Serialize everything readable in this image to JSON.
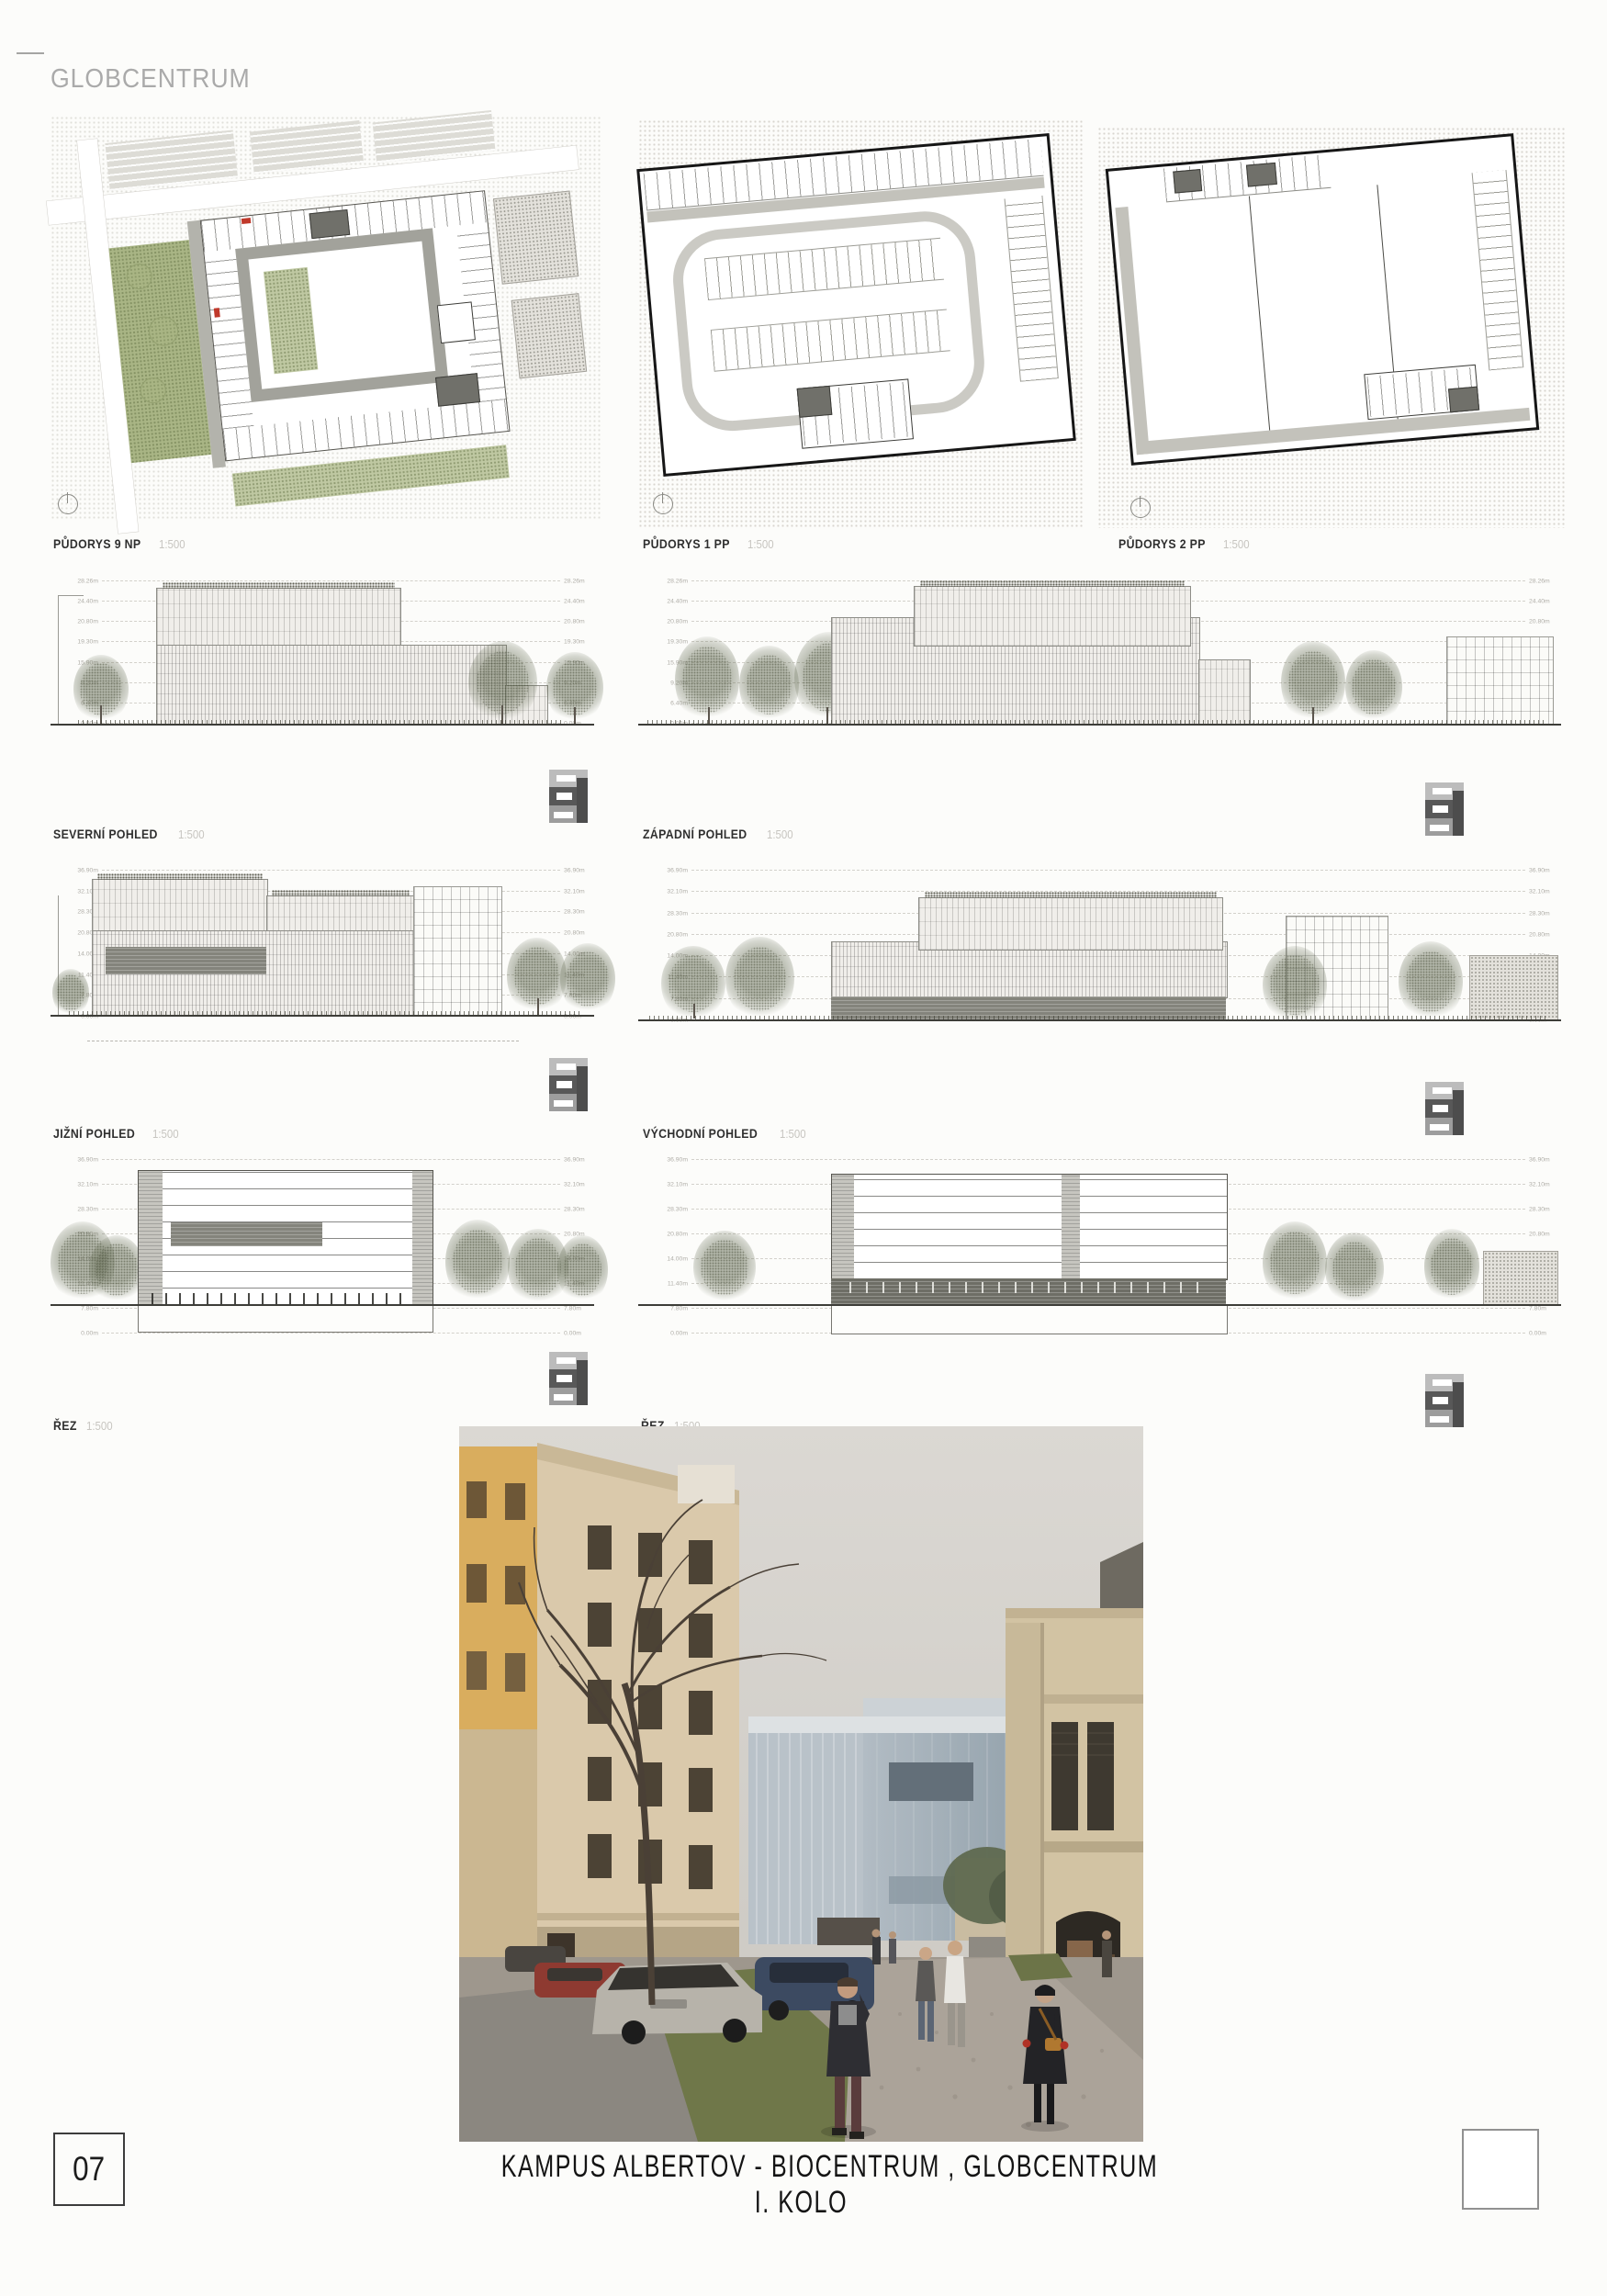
{
  "board": {
    "title": "GLOBCENTRUM",
    "page_number": "07",
    "caption_line1": "KAMPUS ALBERTOV - BIOCENTRUM , GLOBCENTRUM",
    "caption_line2": "I. KOLO"
  },
  "panels": {
    "plan_9np": {
      "label": "PŮDORYS 9 NP",
      "scale": "1:500"
    },
    "plan_1pp": {
      "label": "PŮDORYS 1 PP",
      "scale": "1:500"
    },
    "plan_2pp": {
      "label": "PŮDORYS 2 PP",
      "scale": "1:500"
    },
    "elev_north": {
      "label": "SEVERNÍ POHLED",
      "scale": "1:500"
    },
    "elev_west": {
      "label": "ZÁPADNÍ POHLED",
      "scale": "1:500"
    },
    "elev_south": {
      "label": "JIŽNÍ POHLED",
      "scale": "1:500"
    },
    "elev_east": {
      "label": "VÝCHODNÍ POHLED",
      "scale": "1:500"
    },
    "section_left": {
      "label": "ŘEZ",
      "scale": "1:500"
    },
    "section_right": {
      "label": "ŘEZ",
      "scale": "1:500"
    }
  },
  "levels": {
    "elevation": [
      "28.26m",
      "24.40m",
      "20.80m",
      "19.30m",
      "15.90m",
      "9.20m",
      "6.40m",
      "0.00m"
    ],
    "section": [
      "36.90m",
      "32.10m",
      "28.30m",
      "20.80m",
      "14.00m",
      "11.40m",
      "7.80m",
      "0.00m"
    ]
  },
  "colors": {
    "paper": "#fcfcfa",
    "title_gray": "#aaaaaa",
    "label_dark": "#2f2f2f",
    "scale_gray": "#c7c5c0",
    "accent_red": "#c0392b",
    "plan_green": "#a9b585",
    "glass_blue": "#a9b4bd"
  }
}
